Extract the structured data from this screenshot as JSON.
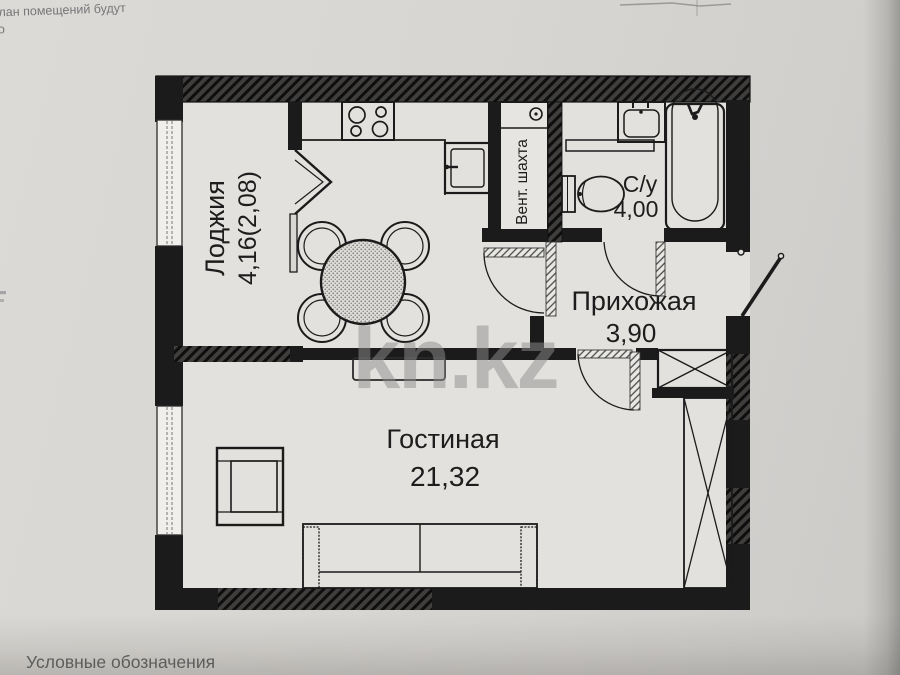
{
  "page": {
    "handwriting_line1": "план помещений будут",
    "handwriting_line2": "то",
    "legend_label": "Условные обозначения",
    "watermark": "kn.kz"
  },
  "plan": {
    "rooms": [
      {
        "id": "loggia",
        "name": "Лоджия",
        "area": "4,16(2,08)"
      },
      {
        "id": "bathroom",
        "name": "С/у",
        "area": "4,00"
      },
      {
        "id": "hallway",
        "name": "Прихожая",
        "area": "3,90"
      },
      {
        "id": "living-room",
        "name": "Гостиная",
        "area": "21,32"
      }
    ],
    "vent_shaft_label": "Вент. шахта",
    "colors": {
      "wall": "#1b1b1b",
      "paper": "#d8d6d2",
      "plan_floor": "#e2e1de",
      "watermark": "#8f8f8f"
    }
  }
}
